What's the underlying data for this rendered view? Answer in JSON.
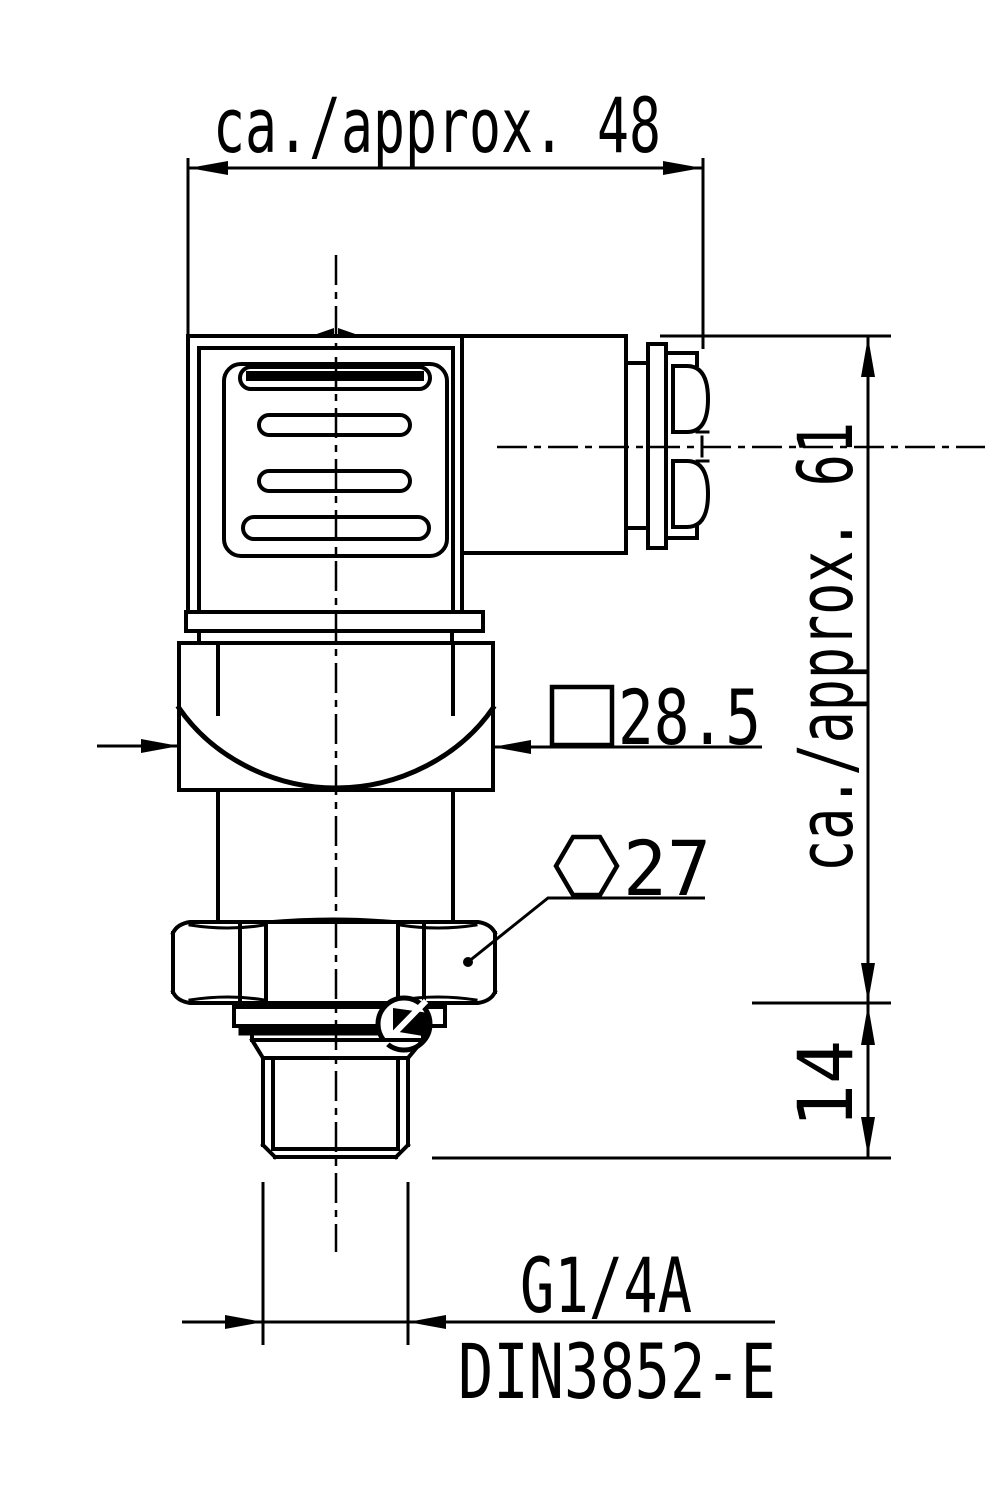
{
  "drawing": {
    "labels": {
      "top_width": "ca./approx. 48",
      "overall_height": "ca./approx. 61",
      "thread_length": "14",
      "square_size": "28.5",
      "hex_size": "27",
      "thread_type": "G1/4A",
      "thread_standard": "DIN3852-E"
    },
    "symbols": {
      "square_symbol": "square (wrench flats 28.5)",
      "hexagon_symbol": "hex (wrench size 27)"
    },
    "colors": {
      "line": "#000000",
      "background": "#ffffff"
    }
  }
}
